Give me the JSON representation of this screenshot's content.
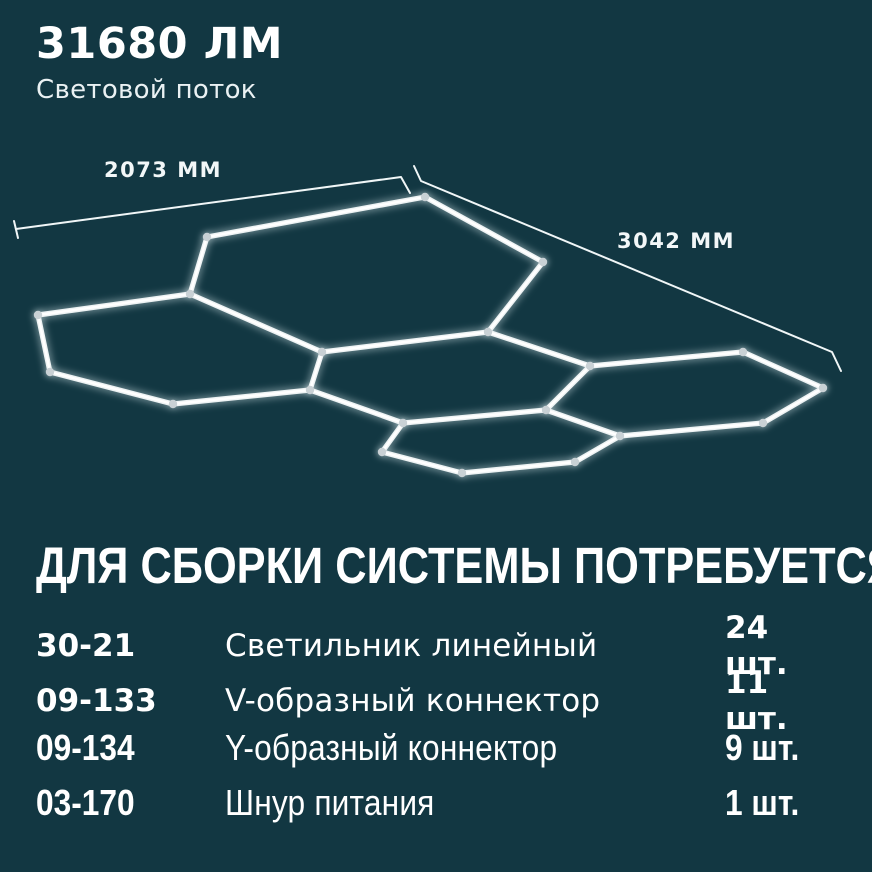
{
  "colors": {
    "background": "#123742",
    "text": "#ffffff",
    "tube_core": "#ffffff",
    "tube_body": "#eef3f4",
    "tube_glow": "#dfeef2",
    "joint": "#c9d1d5",
    "dimension_line": "#f0f6f7"
  },
  "header": {
    "lumens_value": "31680 ЛМ",
    "lumens_label": "Световой поток"
  },
  "diagram": {
    "dimensions": [
      {
        "label": "2073 ММ",
        "points": [
          [
            14,
            221
          ],
          [
            18,
            238
          ]
        ],
        "line": [
          [
            16,
            229
          ],
          [
            401,
            177
          ],
          [
            410,
            193
          ]
        ]
      },
      {
        "label": "3042 ММ",
        "points": [],
        "line": [
          [
            414,
            166
          ],
          [
            421,
            181
          ],
          [
            832,
            352
          ],
          [
            841,
            371
          ]
        ]
      }
    ],
    "nodes": {
      "A": [
        207,
        237
      ],
      "B": [
        425,
        197
      ],
      "C": [
        543,
        262
      ],
      "D": [
        488,
        332
      ],
      "E": [
        322,
        352
      ],
      "F": [
        190,
        294
      ],
      "G": [
        38,
        315
      ],
      "H": [
        50,
        372
      ],
      "I": [
        173,
        404
      ],
      "J": [
        310,
        390
      ],
      "K": [
        546,
        410
      ],
      "M": [
        403,
        423
      ],
      "P": [
        590,
        366
      ],
      "Q": [
        743,
        352
      ],
      "R": [
        823,
        388
      ],
      "S": [
        763,
        423
      ],
      "T": [
        620,
        436
      ],
      "W": [
        382,
        452
      ],
      "V": [
        462,
        473
      ],
      "X": [
        575,
        462
      ]
    },
    "edges": [
      [
        "A",
        "B"
      ],
      [
        "B",
        "C"
      ],
      [
        "C",
        "D"
      ],
      [
        "D",
        "E"
      ],
      [
        "E",
        "F"
      ],
      [
        "F",
        "A"
      ],
      [
        "F",
        "G"
      ],
      [
        "G",
        "H"
      ],
      [
        "H",
        "I"
      ],
      [
        "I",
        "J"
      ],
      [
        "J",
        "E"
      ],
      [
        "D",
        "P"
      ],
      [
        "P",
        "K"
      ],
      [
        "K",
        "M"
      ],
      [
        "M",
        "J"
      ],
      [
        "P",
        "Q"
      ],
      [
        "Q",
        "R"
      ],
      [
        "R",
        "S"
      ],
      [
        "S",
        "T"
      ],
      [
        "T",
        "K"
      ],
      [
        "T",
        "X"
      ],
      [
        "X",
        "V"
      ],
      [
        "V",
        "W"
      ],
      [
        "W",
        "M"
      ]
    ]
  },
  "parts": {
    "title": "ДЛЯ СБОРКИ СИСТЕМЫ ПОТРЕБУЕТСЯ",
    "rows": [
      {
        "code": "30-21",
        "name": "Светильник линейный",
        "qty": "24 шт."
      },
      {
        "code": "09-133",
        "name": "V-образный коннектор",
        "qty": "11 шт."
      },
      {
        "code": "09-134",
        "name": "Y-образный коннектор",
        "qty": "9 шт."
      },
      {
        "code": "03-170",
        "name": "Шнур питания",
        "qty": "1 шт."
      }
    ]
  }
}
